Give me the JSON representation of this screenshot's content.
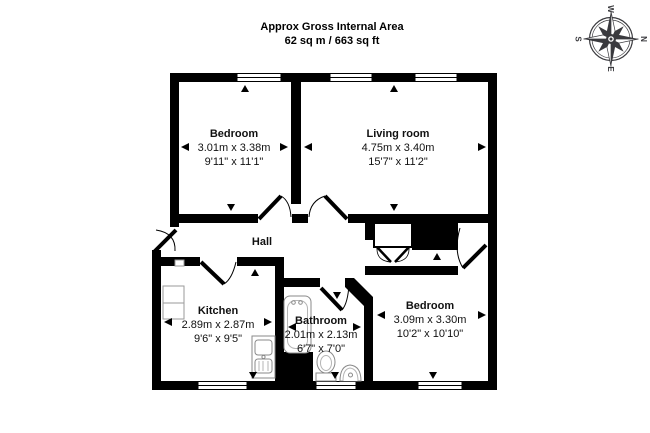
{
  "title": {
    "line1": "Approx Gross Internal Area",
    "line2": "62 sq m / 663 sq ft"
  },
  "compass": {
    "n": "N",
    "e": "E",
    "s": "S",
    "w": "W"
  },
  "rooms": {
    "bedroom1": {
      "name": "Bedroom",
      "metric": "3.01m x 3.38m",
      "imperial": "9'11\" x 11'1\""
    },
    "living": {
      "name": "Living room",
      "metric": "4.75m x 3.40m",
      "imperial": "15'7\" x 11'2\""
    },
    "hall": {
      "name": "Hall"
    },
    "kitchen": {
      "name": "Kitchen",
      "metric": "2.89m x 2.87m",
      "imperial": "9'6\" x 9'5\""
    },
    "bathroom": {
      "name": "Bathroom",
      "metric": "2.01m x 2.13m",
      "imperial": "6'7\" x 7'0\""
    },
    "bedroom2": {
      "name": "Bedroom",
      "metric": "3.09m x 3.30m",
      "imperial": "10'2\" x 10'10\""
    }
  },
  "colors": {
    "wall": "#000000",
    "fixture": "#8a8a8a",
    "fixture_light": "#b5b5b5",
    "compass": "#3a3a3e",
    "background": "#ffffff"
  }
}
